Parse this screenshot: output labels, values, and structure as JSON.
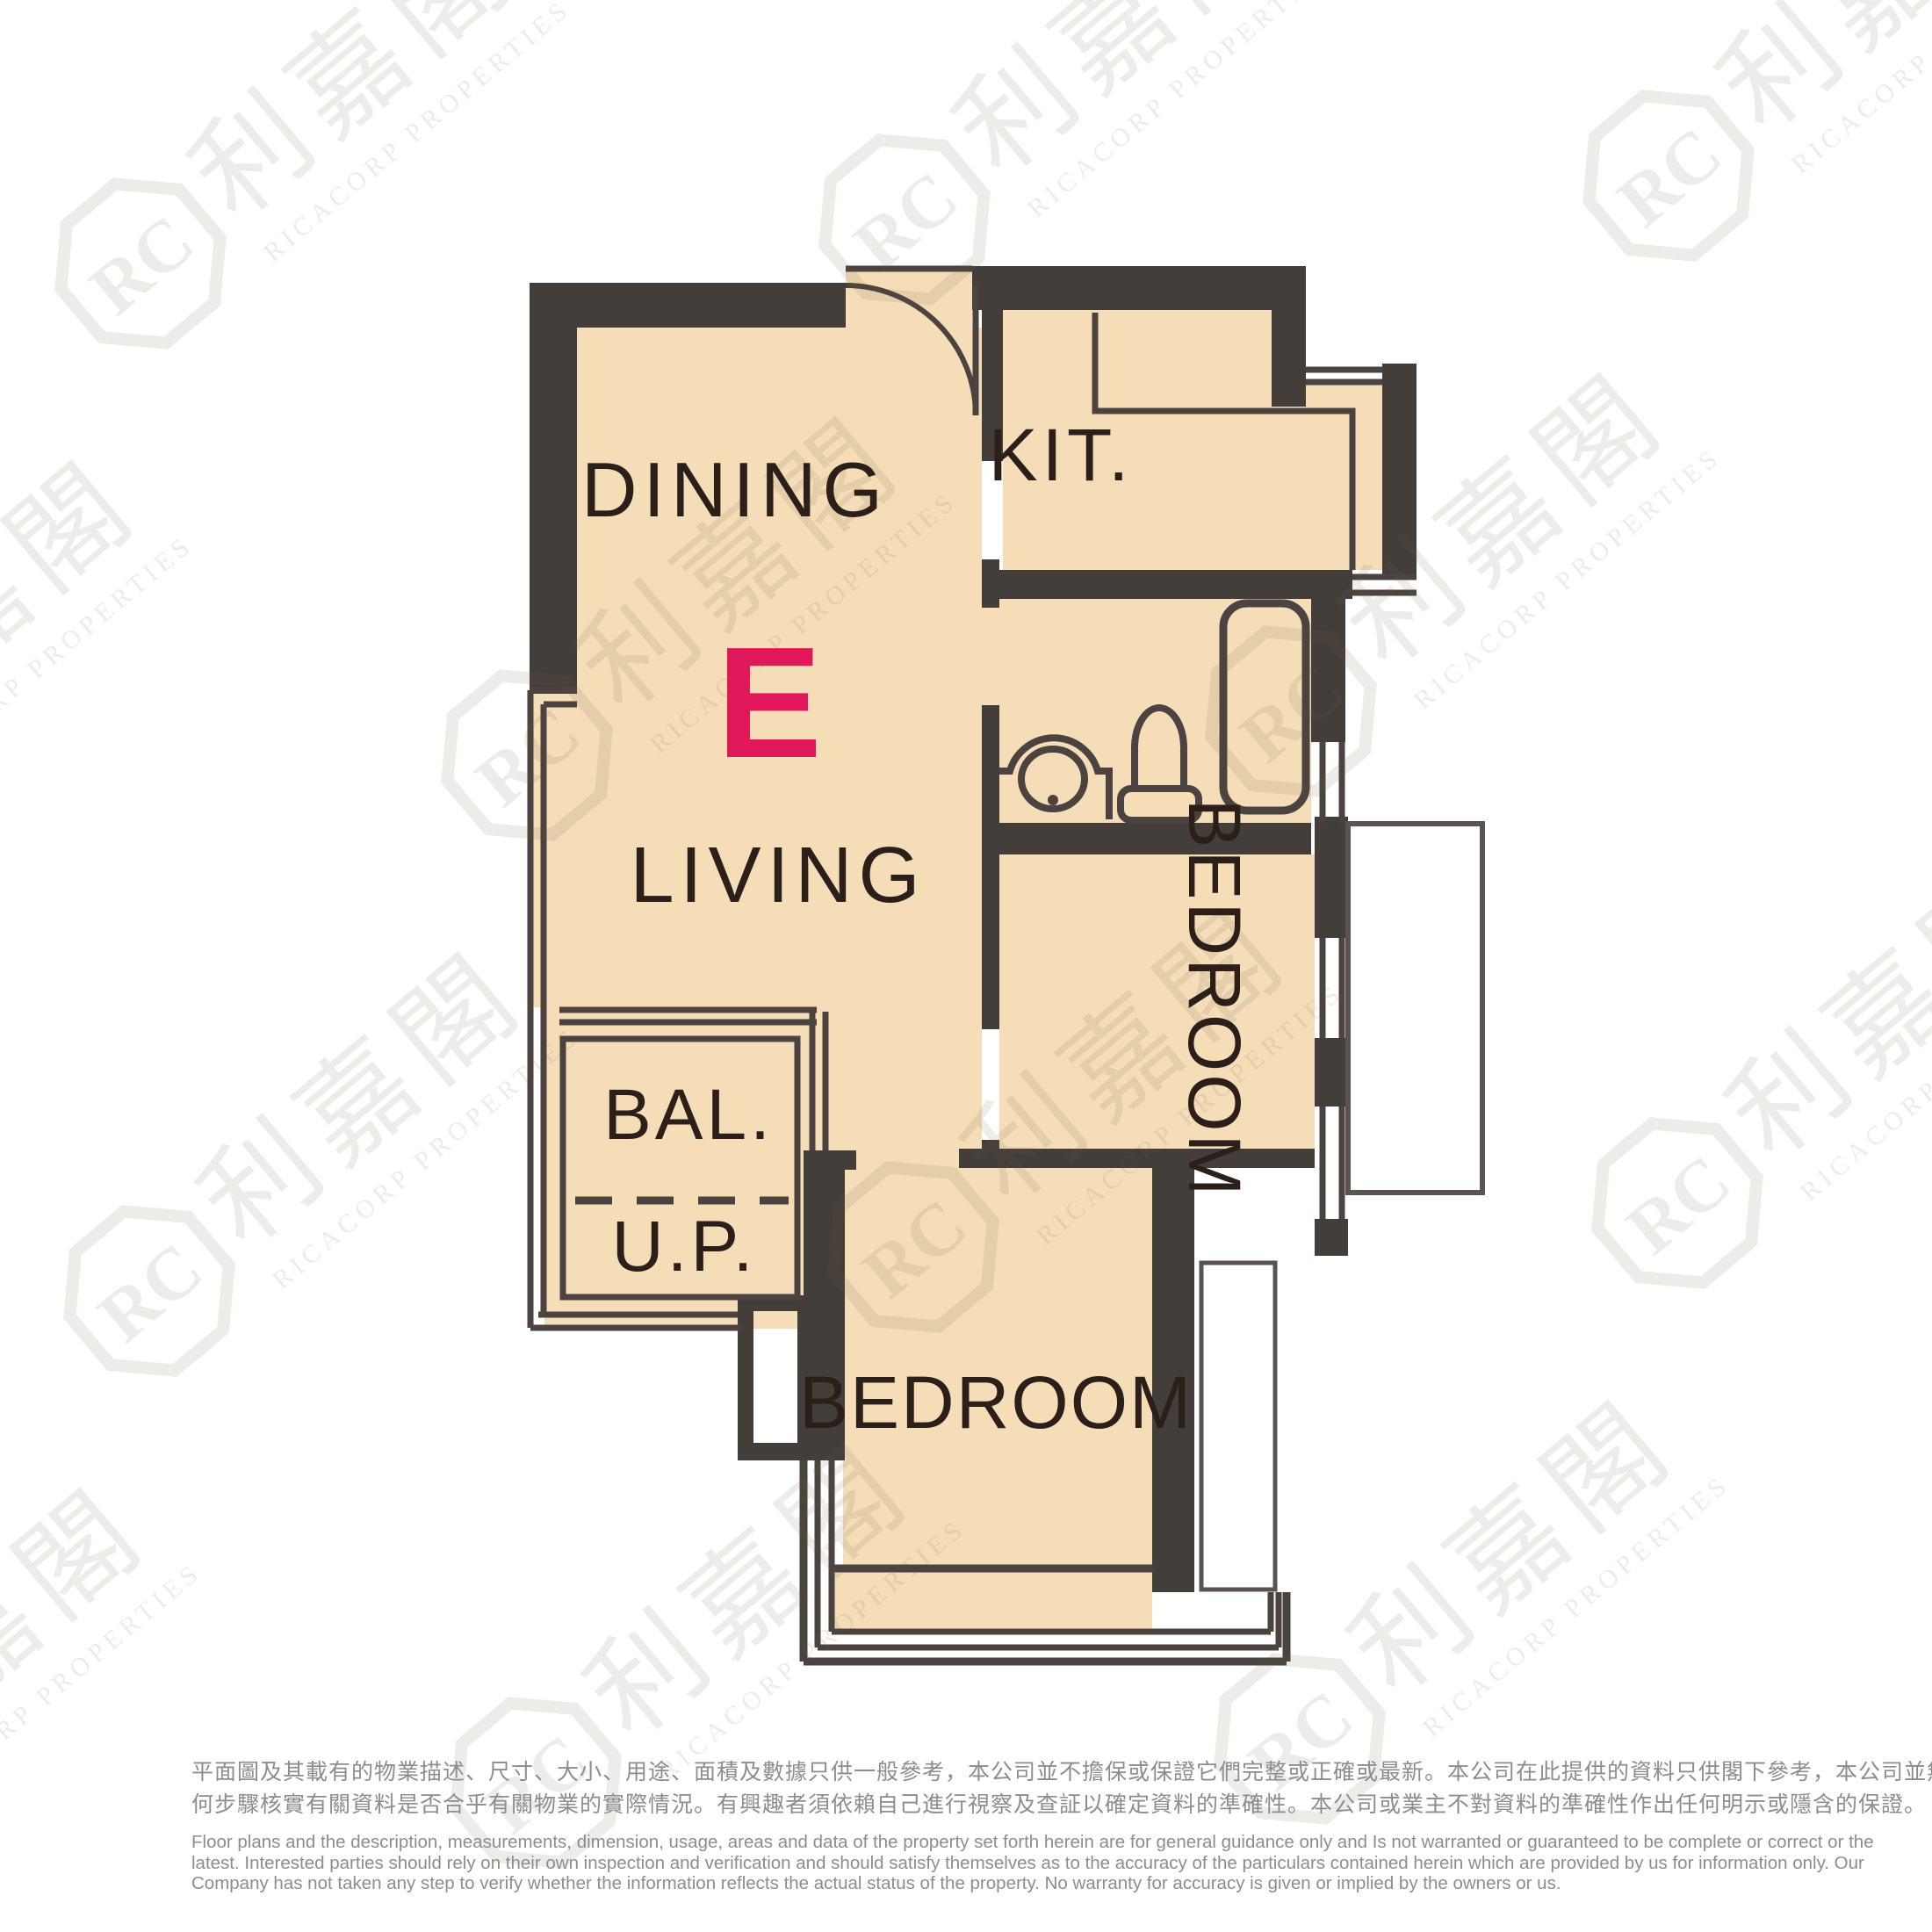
{
  "floorplan": {
    "unit_label": "E",
    "labels": {
      "dining": "DINING",
      "kitchen": "KIT.",
      "living": "LIVING",
      "bedroom_right": "BEDROOM",
      "balcony": "BAL.",
      "utility_platform": "U.P.",
      "bedroom_bottom": "BEDROOM"
    },
    "colors": {
      "wall": "#443e3b",
      "floor": "#f5ddb8",
      "accent": "#e0175a",
      "label_dark": "#2a2019",
      "outline": "#4a433f"
    }
  },
  "watermark": {
    "monogram": "RC",
    "brand_cjk": "利嘉閣",
    "brand_latin": "RICACORP PROPERTIES"
  },
  "disclaimer": {
    "zh_line1": "平面圖及其載有的物業描述、尺寸、大小、用途、面積及數據只供一般參考，本公司並不擔保或保證它們完整或正確或最新。本公司在此提供的資料只供閣下參考，本公司並無採取任",
    "zh_line2": "何步驟核實有關資料是否合乎有關物業的實際情況。有興趣者須依賴自己進行視察及查証以確定資料的準確性。本公司或業主不對資料的準確性作出任何明示或隱含的保證。",
    "en_line1": "Floor plans and the description, measurements, dimension, usage, areas and data of the property set forth herein are for general guidance only and Is not warranted or guaranteed to be complete or correct or the",
    "en_line2": "latest. Interested parties should rely on their own inspection and verification and should satisfy themselves as to the accuracy of the particulars contained herein which are provided by us for information only.  Our",
    "en_line3": "Company has not taken any step to verify whether the information reflects the actual status of the property.  No warranty for accuracy is given or implied by the owners or us."
  }
}
